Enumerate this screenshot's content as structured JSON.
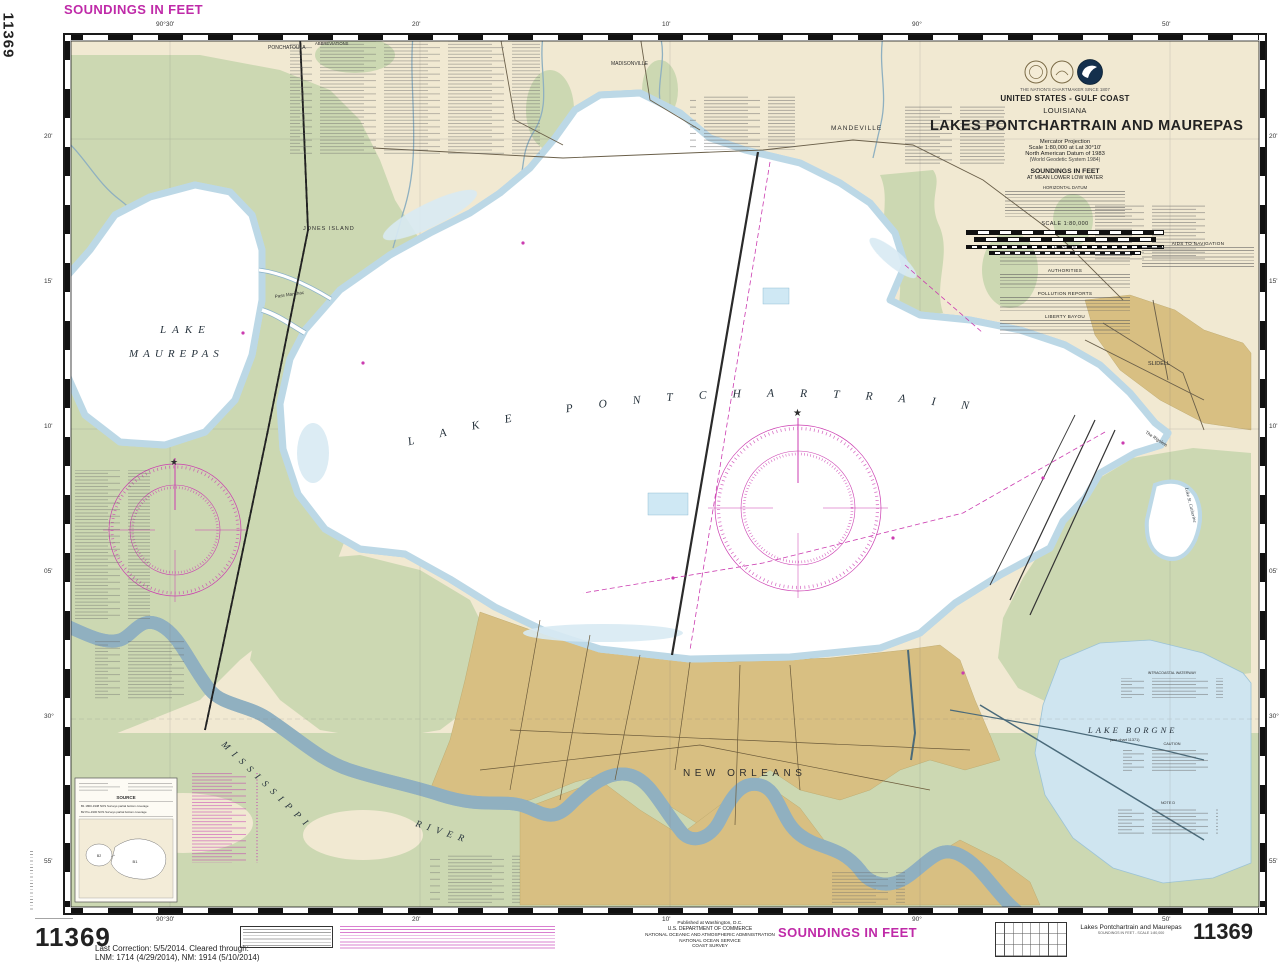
{
  "margins": {
    "soundings_top": "SOUNDINGS IN FEET",
    "soundings_bottom": "SOUNDINGS IN FEET",
    "chart_no_side": "11369",
    "chart_no_bottom_left": "11369",
    "chart_no_bottom_right": "11369",
    "last_correction_1": "Last Correction: 5/5/2014.  Cleared through:",
    "last_correction_2": "LNM: 1714 (4/29/2014), NM: 1914 (5/10/2014)",
    "publisher_1": "Published at Washington, D.C.",
    "publisher_2": "U.S. DEPARTMENT OF COMMERCE",
    "publisher_3": "NATIONAL OCEANIC AND ATMOSPHERIC ADMINISTRATION",
    "publisher_4": "NATIONAL OCEAN SERVICE",
    "publisher_5": "COAST SURVEY",
    "footer_title": "Lakes Pontchartrain and Maurepas",
    "footer_subtitle": "SOUNDINGS IN FEET - SCALE 1:80,000"
  },
  "title_block": {
    "motto": "THE NATION'S CHARTMAKER SINCE 1807",
    "region": "UNITED STATES - GULF COAST",
    "state": "LOUISIANA",
    "title": "LAKES PONTCHARTRAIN AND MAUREPAS",
    "projection": "Mercator Projection",
    "scale": "Scale 1:80,000 at Lat 30°10'",
    "datum1": "North American Datum of 1983",
    "datum2": "(World Geodetic System 1984)",
    "soundings1": "SOUNDINGS IN FEET",
    "soundings2": "AT MEAN LOWER LOW WATER",
    "datum_note_title": "HORIZONTAL DATUM",
    "scale_caption": "SCALE 1:80,000"
  },
  "notes": {
    "abbreviations": "ABBREVIATIONS",
    "heights": "HEIGHTS",
    "authorities": "AUTHORITIES",
    "pollution": "POLLUTION REPORTS",
    "liberty": "LIBERTY BAYOU",
    "aids": "AIDS TO NAVIGATION",
    "icw": "INTRACOASTAL WATERWAY",
    "caution_borgne": "CAUTION",
    "note_d": "NOTE D"
  },
  "map_labels": {
    "lake": "LAKE",
    "maurepas": "MAUREPAS",
    "pontchartrain": "LAKE PONTCHARTRAIN",
    "jones_island": "JONES ISLAND",
    "mandeville": "MANDEVILLE",
    "ponchatoula": "PONCHATOULA",
    "madisonville": "MADISONVILLE",
    "slidell": "SLIDELL",
    "pass_manchac": "Pass Manchac",
    "rigolets": "The Rigolets",
    "st_catherine": "Lake St. Catherine",
    "new_orleans": "NEW ORLEANS",
    "mississippi": "MISSISSIPPI",
    "river": "RIVER",
    "lake_borgne": "LAKE BORGNE",
    "borgne_sub": "(see chart 11371)"
  },
  "graticule": {
    "lon_30": "90°30'",
    "lon_20": "20'",
    "lon_10": "10'",
    "lon_00": "90°",
    "lon_50": "50'",
    "lat_20": "20'",
    "lat_15": "15'",
    "lat_10": "10'",
    "lat_05": "05'",
    "lat_00": "30°",
    "lat_55": "55'"
  },
  "source_inset": {
    "title": "SOURCE",
    "row1": "B1   1800-1938   NOS Surveys   partial bottom coverage",
    "row2": "B2   Pre-1900   NOS Surveys   partial bottom coverage",
    "zone1": "B1",
    "zone2": "B2"
  }
}
